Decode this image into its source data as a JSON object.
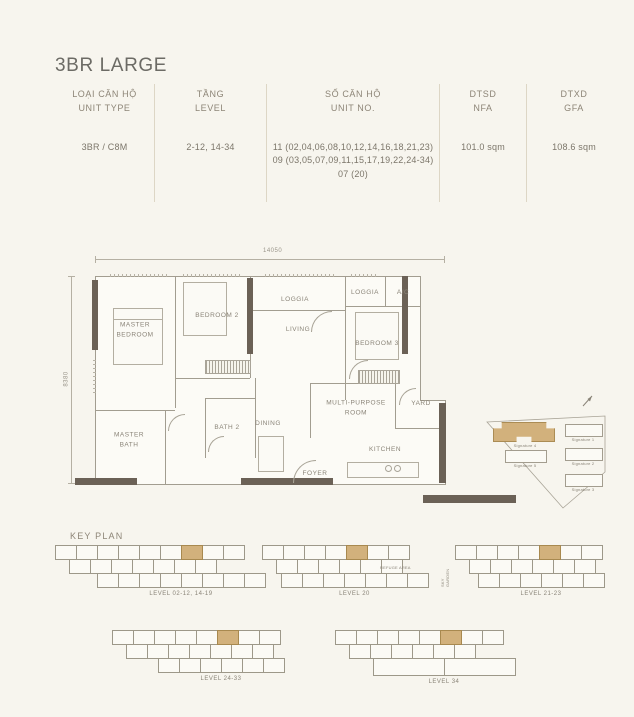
{
  "title": "3BR LARGE",
  "table": {
    "columns": [
      {
        "vi": "LOẠI CĂN HỘ",
        "en": "UNIT TYPE",
        "value": "3BR / C8M"
      },
      {
        "vi": "TẦNG",
        "en": "LEVEL",
        "value": "2-12, 14-34"
      },
      {
        "vi": "SỐ CĂN HỘ",
        "en": "UNIT NO.",
        "value": "11 (02,04,06,08,10,12,14,16,18,21,23)\n09 (03,05,07,09,11,15,17,19,22,24-34)\n07 (20)"
      },
      {
        "vi": "DTSD",
        "en": "NFA",
        "value": "101.0 sqm"
      },
      {
        "vi": "DTXD",
        "en": "GFA",
        "value": "108.6 sqm"
      }
    ]
  },
  "floor_plan": {
    "dim_width": "14050",
    "dim_height": "8380",
    "rooms": {
      "master_bedroom": "MASTER\nBEDROOM",
      "bedroom2": "BEDROOM 2",
      "loggia_left": "LOGGIA",
      "living": "LIVING",
      "loggia_right": "LOGGIA",
      "ac": "A/C",
      "bedroom3": "BEDROOM 3",
      "multi_purpose": "MULTI-PURPOSE\nROOM",
      "yard": "YARD",
      "master_bath": "MASTER\nBATH",
      "bath2": "BATH 2",
      "dining": "DINING",
      "kitchen": "KITCHEN",
      "foyer": "FOYER"
    }
  },
  "site_plan": {
    "buildings": [
      {
        "name": "Signature 4",
        "highlighted": true
      },
      {
        "name": "Signature 1",
        "highlighted": false
      },
      {
        "name": "Signature 2",
        "highlighted": false
      },
      {
        "name": "Signature 3",
        "highlighted": false
      },
      {
        "name": "Signature 5",
        "highlighted": false
      }
    ]
  },
  "key_plan": {
    "title": "KEY PLAN",
    "annotations": {
      "refuge_area": "REFUGE AREA",
      "sky_garden": "SKY GARDEN"
    },
    "levels": [
      {
        "label": "LEVEL 02-12, 14-19",
        "top": 9,
        "mid": 7,
        "bottom": 8,
        "hl": 6,
        "bottom_wide": false
      },
      {
        "label": "LEVEL 20",
        "top": 7,
        "mid": 6,
        "bottom": 7,
        "hl": 4,
        "bottom_wide": false
      },
      {
        "label": "LEVEL 21-23",
        "top": 7,
        "mid": 6,
        "bottom": 6,
        "hl": 4,
        "bottom_wide": false
      },
      {
        "label": "LEVEL 24-33",
        "top": 8,
        "mid": 7,
        "bottom": 6,
        "hl": 5,
        "bottom_wide": false
      },
      {
        "label": "LEVEL 34",
        "top": 8,
        "mid": 6,
        "bottom": 2,
        "hl": 5,
        "bottom_wide": true
      }
    ]
  },
  "colors": {
    "accent_tan": "#d2b17c",
    "wall": "#6b6156",
    "background": "#f7f5ee"
  }
}
